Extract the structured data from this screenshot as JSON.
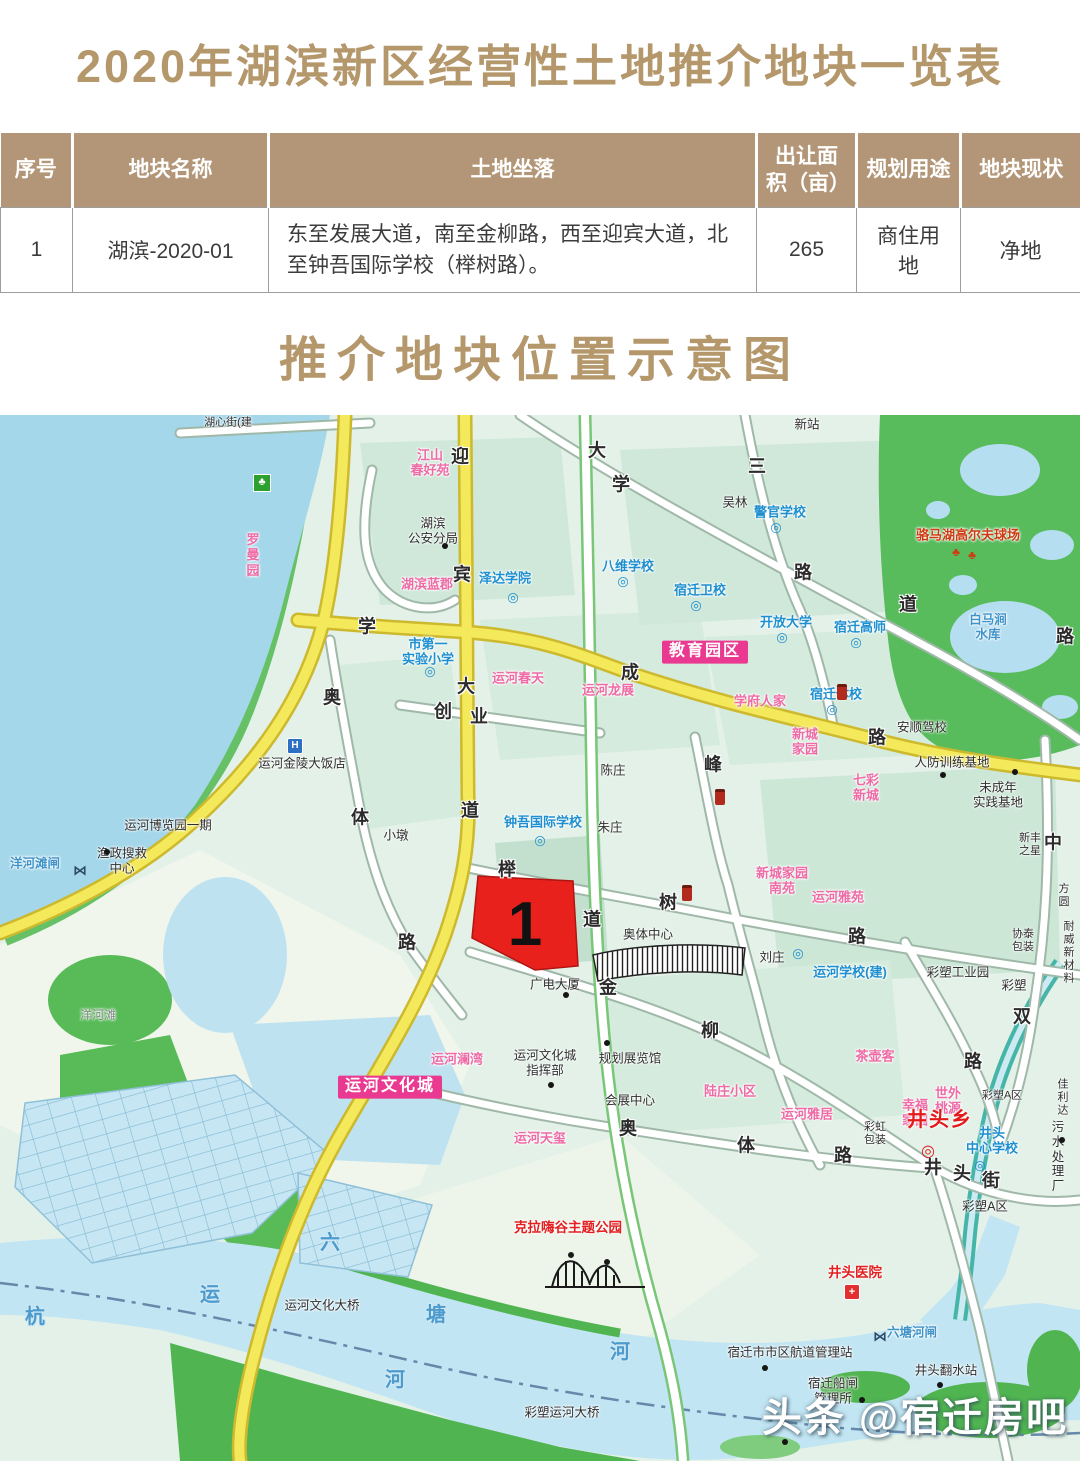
{
  "title": "2020年湖滨新区经营性土地推介地块一览表",
  "map_title": "推介地块位置示意图",
  "table": {
    "headers": [
      "序号",
      "地块名称",
      "土地坐落",
      "出让面积（亩）",
      "规划用途",
      "地块现状"
    ],
    "rows": [
      [
        "1",
        "湖滨-2020-01",
        "东至发展大道，南至金柳路，西至迎宾大道，北至钟吾国际学校（榉树路）。",
        "265",
        "商住用地",
        "净地"
      ]
    ]
  },
  "parcel": {
    "number": "1"
  },
  "watermark": "头条 @宿迁房吧",
  "colors": {
    "accent_gold": "#b4976b",
    "table_header_bg": "#b29677",
    "parcel_red": "#e8211d",
    "school_blue": "#1e8fd0",
    "residence_pink": "#ee6ba6",
    "highlight_magenta": "#ea3990",
    "road_yellow": "#f4e95b",
    "lake_blue": "#a4d7ea"
  },
  "map": {
    "labels": [
      {
        "t": "迎",
        "x": 460,
        "y": 42,
        "c": "road"
      },
      {
        "t": "宾",
        "x": 462,
        "y": 160,
        "c": "road"
      },
      {
        "t": "大",
        "x": 466,
        "y": 272,
        "c": "road"
      },
      {
        "t": "道",
        "x": 470,
        "y": 396,
        "c": "road"
      },
      {
        "t": "大",
        "x": 597,
        "y": 36,
        "c": "road"
      },
      {
        "t": "学",
        "x": 621,
        "y": 70,
        "c": "road"
      },
      {
        "t": "三",
        "x": 757,
        "y": 52,
        "c": "road"
      },
      {
        "t": "路",
        "x": 803,
        "y": 158,
        "c": "road"
      },
      {
        "t": "道",
        "x": 908,
        "y": 190,
        "c": "road"
      },
      {
        "t": "路",
        "x": 1065,
        "y": 222,
        "c": "road"
      },
      {
        "t": "学",
        "x": 367,
        "y": 212,
        "c": "road"
      },
      {
        "t": "成",
        "x": 630,
        "y": 258,
        "c": "road"
      },
      {
        "t": "路",
        "x": 877,
        "y": 323,
        "c": "road"
      },
      {
        "t": "道",
        "x": 592,
        "y": 505,
        "c": "road"
      },
      {
        "t": "榉",
        "x": 507,
        "y": 455,
        "c": "road"
      },
      {
        "t": "树",
        "x": 668,
        "y": 488,
        "c": "road"
      },
      {
        "t": "路",
        "x": 857,
        "y": 522,
        "c": "road"
      },
      {
        "t": "金",
        "x": 608,
        "y": 573,
        "c": "road"
      },
      {
        "t": "柳",
        "x": 710,
        "y": 616,
        "c": "road"
      },
      {
        "t": "峰",
        "x": 713,
        "y": 350,
        "c": "road"
      },
      {
        "t": "奥",
        "x": 332,
        "y": 283,
        "c": "road"
      },
      {
        "t": "体",
        "x": 360,
        "y": 403,
        "c": "road"
      },
      {
        "t": "路",
        "x": 407,
        "y": 528,
        "c": "road"
      },
      {
        "t": "创",
        "x": 443,
        "y": 297,
        "c": "road"
      },
      {
        "t": "业",
        "x": 479,
        "y": 302,
        "c": "road"
      },
      {
        "t": "奥",
        "x": 628,
        "y": 714,
        "c": "road"
      },
      {
        "t": "体",
        "x": 746,
        "y": 731,
        "c": "road"
      },
      {
        "t": "路",
        "x": 843,
        "y": 741,
        "c": "road"
      },
      {
        "t": "井",
        "x": 933,
        "y": 753,
        "c": "road"
      },
      {
        "t": "头",
        "x": 962,
        "y": 759,
        "c": "road"
      },
      {
        "t": "街",
        "x": 991,
        "y": 766,
        "c": "road"
      },
      {
        "t": "双",
        "x": 1022,
        "y": 602,
        "c": "road"
      },
      {
        "t": "中",
        "x": 1053,
        "y": 428,
        "c": "road"
      },
      {
        "t": "路",
        "x": 973,
        "y": 647,
        "c": "road"
      },
      {
        "t": "杭",
        "x": 35,
        "y": 903,
        "c": "water"
      },
      {
        "t": "运",
        "x": 210,
        "y": 881,
        "c": "water"
      },
      {
        "t": "河",
        "x": 395,
        "y": 966,
        "c": "water"
      },
      {
        "t": "六",
        "x": 330,
        "y": 829,
        "c": "water"
      },
      {
        "t": "塘",
        "x": 436,
        "y": 901,
        "c": "water"
      },
      {
        "t": "河",
        "x": 620,
        "y": 938,
        "c": "water"
      },
      {
        "t": "湖心街(建",
        "x": 228,
        "y": 8,
        "c": "blk small"
      },
      {
        "t": "江山\n春好苑",
        "x": 430,
        "y": 48,
        "c": "res"
      },
      {
        "t": "湖滨\n公安分局",
        "x": 433,
        "y": 116,
        "c": "blk"
      },
      {
        "t": "罗\n曼\n园",
        "x": 253,
        "y": 140,
        "c": "res"
      },
      {
        "t": "泽达学院",
        "x": 505,
        "y": 163,
        "c": "sch"
      },
      {
        "t": "湖滨蓝郡",
        "x": 427,
        "y": 169,
        "c": "res"
      },
      {
        "t": "八维学校",
        "x": 628,
        "y": 151,
        "c": "sch"
      },
      {
        "t": "宿迁卫校",
        "x": 700,
        "y": 175,
        "c": "sch"
      },
      {
        "t": "警官学校",
        "x": 780,
        "y": 97,
        "c": "sch"
      },
      {
        "t": "开放大学",
        "x": 786,
        "y": 207,
        "c": "sch"
      },
      {
        "t": "宿迁高师",
        "x": 860,
        "y": 212,
        "c": "sch"
      },
      {
        "t": "教育园区",
        "x": 705,
        "y": 237,
        "c": "pinkbox",
        "n": "education-district-badge"
      },
      {
        "t": "宿迁体校",
        "x": 836,
        "y": 279,
        "c": "sch"
      },
      {
        "t": "市第一\n实验小学",
        "x": 428,
        "y": 237,
        "c": "sch"
      },
      {
        "t": "运河春天",
        "x": 518,
        "y": 263,
        "c": "res"
      },
      {
        "t": "运河龙展",
        "x": 608,
        "y": 275,
        "c": "res"
      },
      {
        "t": "吴林",
        "x": 735,
        "y": 88,
        "c": "blk"
      },
      {
        "t": "新站",
        "x": 807,
        "y": 10,
        "c": "blk"
      },
      {
        "t": "学府人家",
        "x": 760,
        "y": 286,
        "c": "res"
      },
      {
        "t": "新城\n家园",
        "x": 805,
        "y": 327,
        "c": "res"
      },
      {
        "t": "七彩\n新城",
        "x": 866,
        "y": 373,
        "c": "res"
      },
      {
        "t": "安顺驾校",
        "x": 922,
        "y": 313,
        "c": "blk"
      },
      {
        "t": "人防训练基地",
        "x": 952,
        "y": 348,
        "c": "blk"
      },
      {
        "t": "未成年\n实践基地",
        "x": 998,
        "y": 380,
        "c": "blk"
      },
      {
        "t": "骆马湖高尔夫球场",
        "x": 968,
        "y": 120,
        "c": "golfred"
      },
      {
        "t": "白马涧\n水库",
        "x": 988,
        "y": 212,
        "c": "wl"
      },
      {
        "t": "新丰\n之星",
        "x": 1030,
        "y": 430,
        "c": "blk small"
      },
      {
        "t": "方圆",
        "x": 1064,
        "y": 481,
        "c": "blk small"
      },
      {
        "t": "协泰\n包装",
        "x": 1023,
        "y": 526,
        "c": "blk small"
      },
      {
        "t": "耐威\n新材料",
        "x": 1069,
        "y": 538,
        "c": "blk small"
      },
      {
        "t": "运河金陵大饭店",
        "x": 302,
        "y": 349,
        "c": "blk"
      },
      {
        "t": "运河博览园一期",
        "x": 168,
        "y": 411,
        "c": "blk"
      },
      {
        "t": "渔政搜救\n中心",
        "x": 122,
        "y": 446,
        "c": "blk"
      },
      {
        "t": "洋河滩闸",
        "x": 35,
        "y": 449,
        "c": "wl"
      },
      {
        "t": "洋河滩",
        "x": 98,
        "y": 600,
        "c": "gray"
      },
      {
        "t": "小墩",
        "x": 396,
        "y": 421,
        "c": "blk"
      },
      {
        "t": "陈庄",
        "x": 613,
        "y": 356,
        "c": "blk"
      },
      {
        "t": "朱庄",
        "x": 610,
        "y": 413,
        "c": "blk"
      },
      {
        "t": "钟吾国际学校",
        "x": 543,
        "y": 407,
        "c": "sch"
      },
      {
        "t": "刘庄",
        "x": 772,
        "y": 543,
        "c": "blk"
      },
      {
        "t": "运河学校(建)",
        "x": 850,
        "y": 557,
        "c": "sch"
      },
      {
        "t": "新城家园\n南苑",
        "x": 782,
        "y": 466,
        "c": "res"
      },
      {
        "t": "运河雅苑",
        "x": 838,
        "y": 482,
        "c": "res"
      },
      {
        "t": "奥体中心",
        "x": 648,
        "y": 520,
        "c": "blk"
      },
      {
        "t": "广电大厦",
        "x": 555,
        "y": 570,
        "c": "blk"
      },
      {
        "t": "运河澜湾",
        "x": 457,
        "y": 644,
        "c": "res"
      },
      {
        "t": "运河文化城",
        "x": 390,
        "y": 672,
        "c": "pinkbox",
        "n": "canal-culture-city-badge"
      },
      {
        "t": "运河文化城\n指挥部",
        "x": 545,
        "y": 648,
        "c": "blk"
      },
      {
        "t": "规划展览馆",
        "x": 630,
        "y": 644,
        "c": "blk"
      },
      {
        "t": "会展中心",
        "x": 630,
        "y": 686,
        "c": "blk"
      },
      {
        "t": "陆庄小区",
        "x": 730,
        "y": 676,
        "c": "res"
      },
      {
        "t": "运河雅居",
        "x": 807,
        "y": 699,
        "c": "res"
      },
      {
        "t": "运河天玺",
        "x": 540,
        "y": 723,
        "c": "res"
      },
      {
        "t": "茶壶客",
        "x": 875,
        "y": 641,
        "c": "res"
      },
      {
        "t": "彩虹\n包装",
        "x": 875,
        "y": 719,
        "c": "blk small"
      },
      {
        "t": "彩塑工业园",
        "x": 958,
        "y": 558,
        "c": "blk"
      },
      {
        "t": "彩塑",
        "x": 1014,
        "y": 571,
        "c": "blk"
      },
      {
        "t": "世外\n桃源",
        "x": 948,
        "y": 686,
        "c": "res"
      },
      {
        "t": "幸福\n家园",
        "x": 915,
        "y": 698,
        "c": "res"
      },
      {
        "t": "井头乡",
        "x": 940,
        "y": 706,
        "c": "redbig",
        "n": "town-label"
      },
      {
        "t": "井头\n中心学校",
        "x": 992,
        "y": 726,
        "c": "sch"
      },
      {
        "t": "污水\n处理厂",
        "x": 1058,
        "y": 742,
        "c": "blk"
      },
      {
        "t": "彩塑A区",
        "x": 1002,
        "y": 681,
        "c": "blk small"
      },
      {
        "t": "佳利达",
        "x": 1063,
        "y": 683,
        "c": "blk small"
      },
      {
        "t": "彩塑A区",
        "x": 985,
        "y": 792,
        "c": "blk"
      },
      {
        "t": "井头医院",
        "x": 855,
        "y": 858,
        "c": "red"
      },
      {
        "t": "六塘河闸",
        "x": 912,
        "y": 918,
        "c": "wl"
      },
      {
        "t": "宿迁市市区航道管理站",
        "x": 790,
        "y": 938,
        "c": "blk"
      },
      {
        "t": "宿迁船闸\n管理所",
        "x": 833,
        "y": 976,
        "c": "blk"
      },
      {
        "t": "井头翻水站",
        "x": 946,
        "y": 956,
        "c": "blk"
      },
      {
        "t": "运河文化大桥",
        "x": 322,
        "y": 891,
        "c": "blk"
      },
      {
        "t": "彩塑运河大桥",
        "x": 562,
        "y": 998,
        "c": "blk"
      },
      {
        "t": "克拉嗨谷主题公园",
        "x": 568,
        "y": 813,
        "c": "red"
      }
    ],
    "icons": [
      {
        "t": "dot",
        "x": 445,
        "y": 131
      },
      {
        "t": "school",
        "x": 513,
        "y": 182
      },
      {
        "t": "school",
        "x": 623,
        "y": 166
      },
      {
        "t": "school",
        "x": 696,
        "y": 190
      },
      {
        "t": "school",
        "x": 776,
        "y": 112
      },
      {
        "t": "school",
        "x": 782,
        "y": 222
      },
      {
        "t": "school",
        "x": 856,
        "y": 227
      },
      {
        "t": "school",
        "x": 832,
        "y": 294
      },
      {
        "t": "school",
        "x": 430,
        "y": 256
      },
      {
        "t": "school",
        "x": 540,
        "y": 425
      },
      {
        "t": "school",
        "x": 798,
        "y": 538
      },
      {
        "t": "school",
        "x": 980,
        "y": 750
      },
      {
        "t": "park",
        "x": 262,
        "y": 68
      },
      {
        "t": "hotel",
        "x": 295,
        "y": 331
      },
      {
        "t": "dot",
        "x": 107,
        "y": 437
      },
      {
        "t": "lock",
        "x": 80,
        "y": 455
      },
      {
        "t": "lock",
        "x": 880,
        "y": 921
      },
      {
        "t": "gas",
        "x": 842,
        "y": 277
      },
      {
        "t": "gas",
        "x": 720,
        "y": 382
      },
      {
        "t": "gas",
        "x": 687,
        "y": 478
      },
      {
        "t": "dot",
        "x": 566,
        "y": 580
      },
      {
        "t": "dot",
        "x": 551,
        "y": 670
      },
      {
        "t": "dot",
        "x": 607,
        "y": 628
      },
      {
        "t": "dot",
        "x": 943,
        "y": 360
      },
      {
        "t": "dot",
        "x": 1015,
        "y": 357
      },
      {
        "t": "dot",
        "x": 1062,
        "y": 725
      },
      {
        "t": "tree",
        "x": 956,
        "y": 137
      },
      {
        "t": "tree",
        "x": 972,
        "y": 140
      },
      {
        "t": "govt",
        "x": 928,
        "y": 737
      },
      {
        "t": "hospital",
        "x": 852,
        "y": 877
      },
      {
        "t": "dot",
        "x": 765,
        "y": 953
      },
      {
        "t": "dot",
        "x": 862,
        "y": 985
      },
      {
        "t": "dot",
        "x": 940,
        "y": 970
      },
      {
        "t": "dot",
        "x": 785,
        "y": 1027
      }
    ]
  }
}
